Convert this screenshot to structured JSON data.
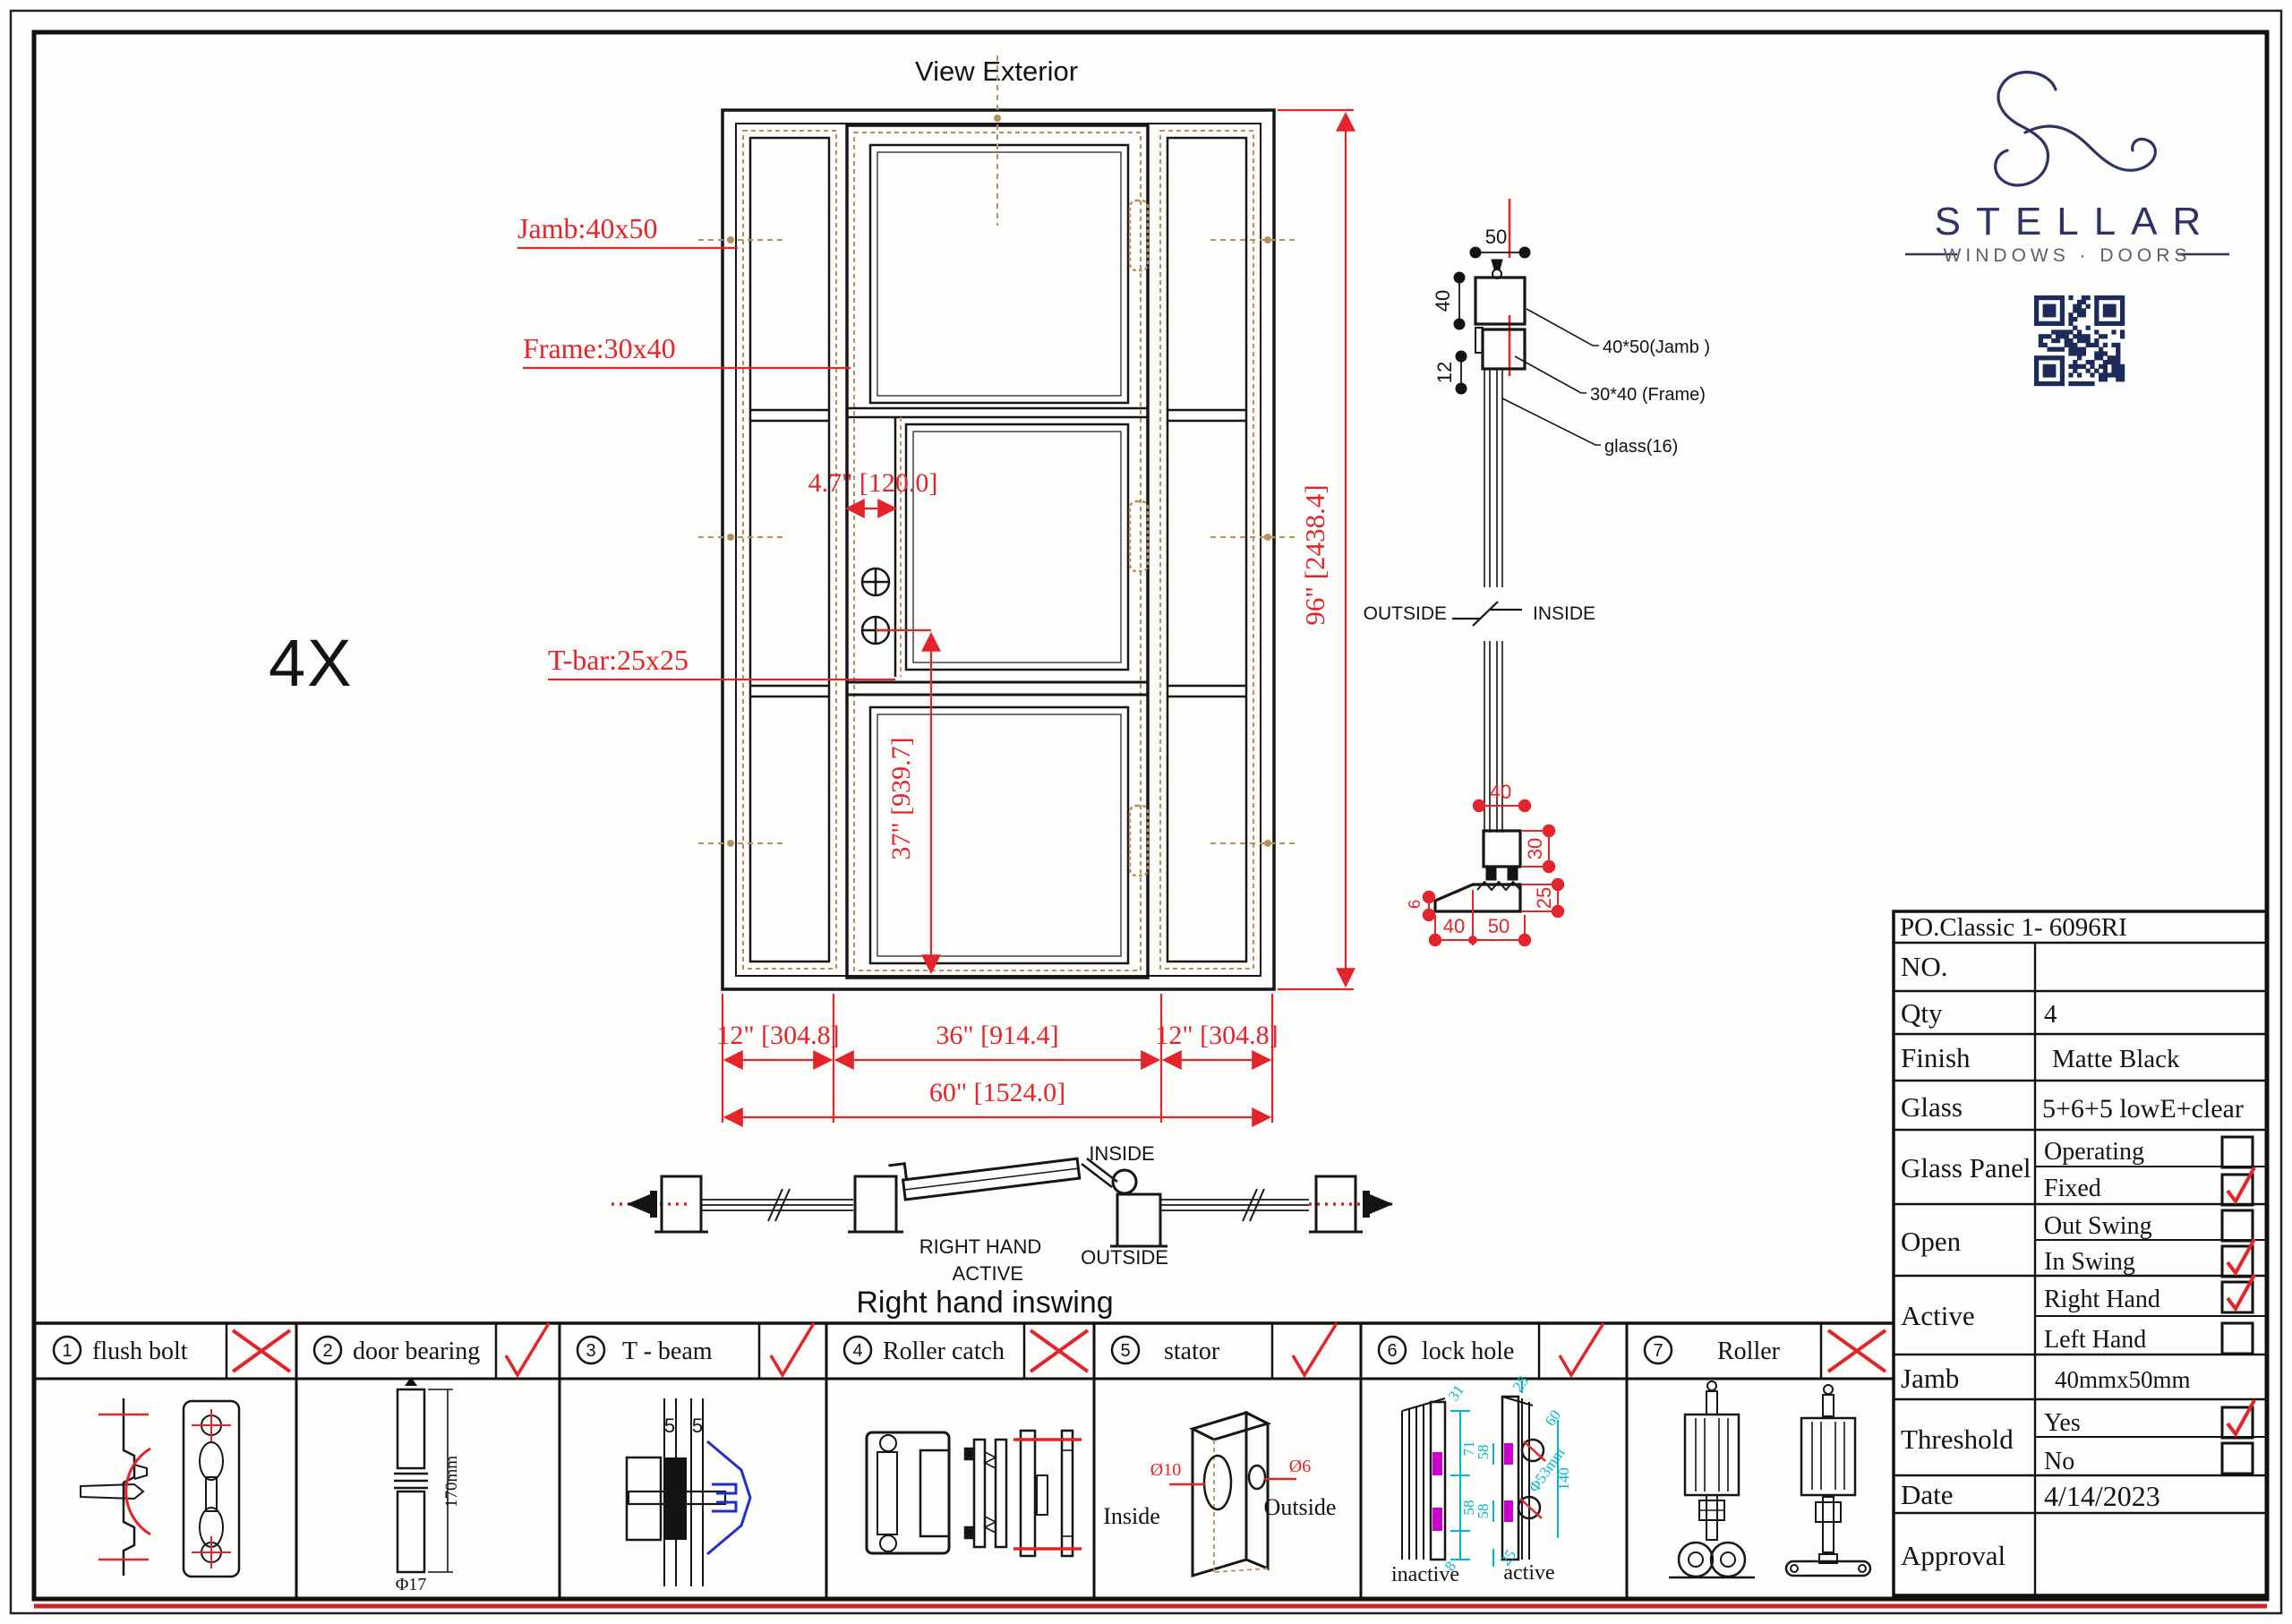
{
  "sheet": {
    "title": "View Exterior",
    "multiplier": "4X",
    "caption": "Right hand inswing"
  },
  "elevation": {
    "jamb_label": "Jamb:40x50",
    "frame_label": "Frame:30x40",
    "tbar_label": "T-bar:25x25",
    "dim_stile": "4.7\" [120.0]",
    "dim_handle": "37\" [939.7]",
    "dim_height": "96\" [2438.4]",
    "dim_left": "12\" [304.8]",
    "dim_center": "36\" [914.4]",
    "dim_right": "12\" [304.8]",
    "dim_total": "60\" [1524.0]"
  },
  "section": {
    "dim_50": "50",
    "dim_40": "40",
    "dim_12": "12",
    "label_jamb": "40*50(Jamb )",
    "label_frame": "30*40 (Frame)",
    "label_glass": "glass(16)",
    "outside": "OUTSIDE",
    "inside": "INSIDE",
    "sill_top_40": "40",
    "sill_30": "30",
    "sill_25": "25",
    "sill_6": "6",
    "sill_40": "40",
    "sill_50": "50"
  },
  "plan": {
    "inside": "INSIDE",
    "outside": "OUTSIDE",
    "active1": "RIGHT HAND",
    "active2": "ACTIVE"
  },
  "logo": {
    "brand": "STELLAR",
    "tagline": "WINDOWS · DOORS"
  },
  "hardware": {
    "items": [
      {
        "num": "1",
        "name": "flush bolt",
        "mark": "x"
      },
      {
        "num": "2",
        "name": "door bearing",
        "mark": "check"
      },
      {
        "num": "3",
        "name": "T - beam",
        "mark": "check"
      },
      {
        "num": "4",
        "name": "Roller catch",
        "mark": "x"
      },
      {
        "num": "5",
        "name": "stator",
        "mark": "check"
      },
      {
        "num": "6",
        "name": "lock hole",
        "mark": "check"
      },
      {
        "num": "7",
        "name": "Roller",
        "mark": "x"
      }
    ],
    "bearing": {
      "length": "170mm",
      "dia": "Φ17"
    },
    "tbeam": {
      "g1": "5",
      "g2": "5"
    },
    "stator": {
      "d1": "Ø10",
      "d2": "Ø6",
      "inside": "Inside",
      "outside": "Outside"
    },
    "lock": {
      "inactive": "inactive",
      "active": "active",
      "dims": [
        "31",
        "71",
        "58",
        "8",
        "25",
        "60",
        "58",
        "58",
        "25",
        "140",
        "Φ53mm"
      ]
    }
  },
  "table": {
    "po": "PO.Classic 1- 6096RI",
    "no_label": "NO.",
    "no_value": "",
    "qty_label": "Qty",
    "qty_value": "4",
    "finish_label": "Finish",
    "finish_value": "Matte Black",
    "glass_label": "Glass",
    "glass_value": "5+6+5  lowE+clear",
    "glass_panel_label": "Glass Panel",
    "operating": "Operating",
    "fixed": "Fixed",
    "open_label": "Open",
    "out_swing": "Out Swing",
    "in_swing": "In Swing",
    "active_label": "Active",
    "right_hand": "Right Hand",
    "left_hand": "Left Hand",
    "jamb_label": "Jamb",
    "jamb_value": "40mmx50mm",
    "threshold_label": "Threshold",
    "yes": "Yes",
    "no": "No",
    "date_label": "Date",
    "date_value": "4/14/2023",
    "approval_label": "Approval",
    "checks": {
      "operating": false,
      "fixed": true,
      "out_swing": false,
      "in_swing": true,
      "right_hand": true,
      "left_hand": false,
      "yes": true,
      "no": false
    }
  }
}
